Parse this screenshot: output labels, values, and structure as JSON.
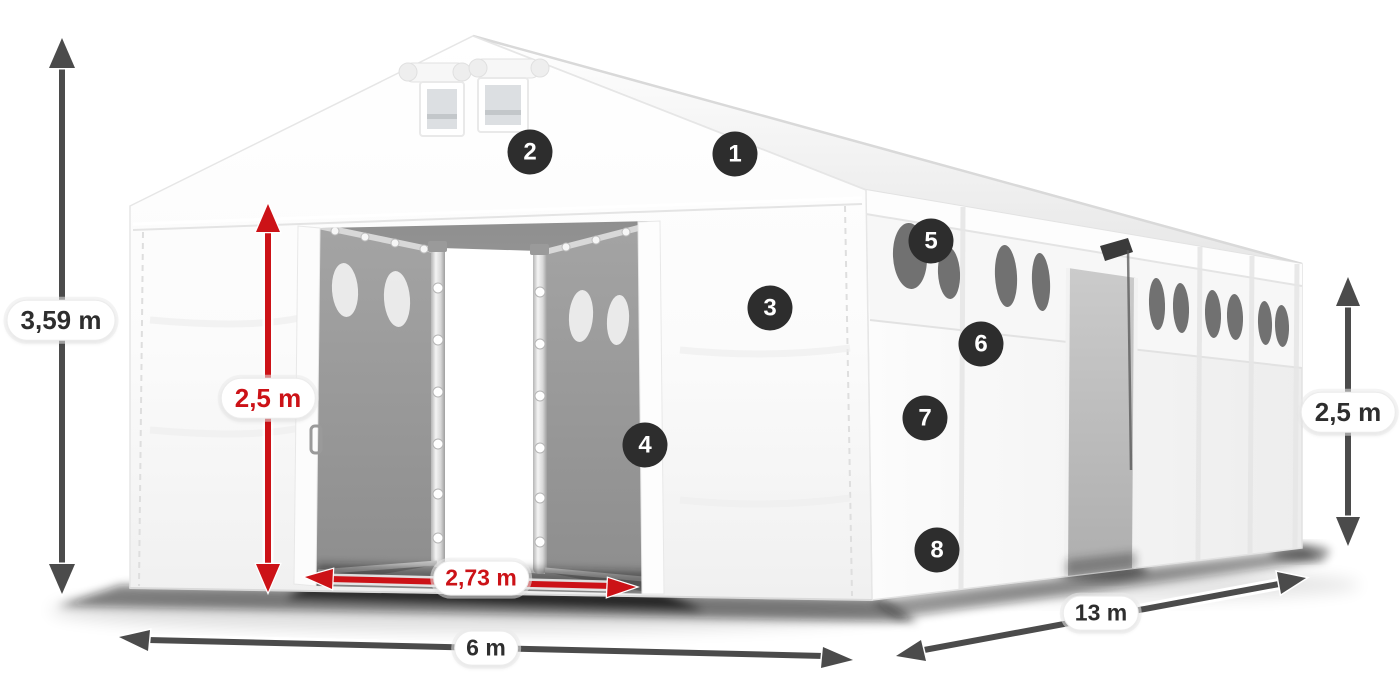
{
  "diagram": {
    "dimensions": {
      "total_height": {
        "value": "3,59 m",
        "color": "dark",
        "orientation": "vertical"
      },
      "entrance_height": {
        "value": "2,5 m",
        "color": "red",
        "orientation": "vertical"
      },
      "entrance_width": {
        "value": "2,73 m",
        "color": "red",
        "orientation": "horizontal"
      },
      "width": {
        "value": "6 m",
        "color": "dark",
        "orientation": "horizontal"
      },
      "length": {
        "value": "13 m",
        "color": "dark",
        "orientation": "diagonal"
      },
      "side_height": {
        "value": "2,5 m",
        "color": "dark",
        "orientation": "vertical"
      }
    },
    "hotspots": [
      {
        "number": "1"
      },
      {
        "number": "2"
      },
      {
        "number": "3"
      },
      {
        "number": "4"
      },
      {
        "number": "5"
      },
      {
        "number": "6"
      },
      {
        "number": "7"
      },
      {
        "number": "8"
      }
    ],
    "colors": {
      "red_accent": "#cc1217",
      "dark_arrow": "#4b4b4b",
      "badge_bg": "#2d2d2d",
      "badge_text": "#ffffff",
      "tent_white": "#ffffff",
      "interior_gray": "#a0a0a0"
    }
  }
}
